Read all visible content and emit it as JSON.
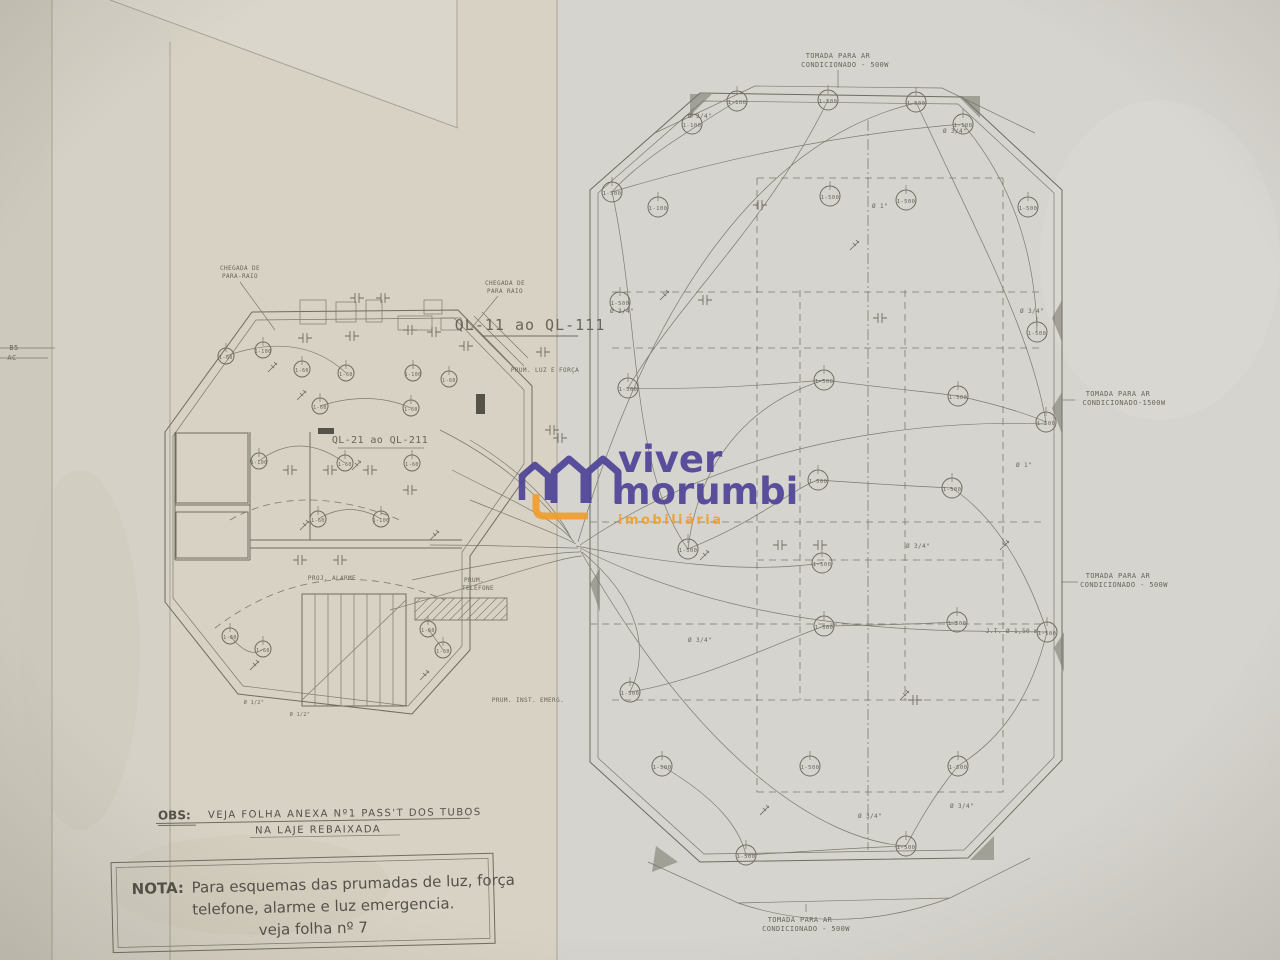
{
  "document": {
    "kind": "electrical floor plan blueprint photo",
    "panel_label_main": "QL-11 ao QL-111",
    "panel_label_secondary": "QL-21 ao QL-211"
  },
  "watermark": {
    "line1": "viver",
    "line2": "morumbi",
    "line3": "imobiliária",
    "purple": "#4f4397",
    "orange": "#f09f2e"
  },
  "obs_note": {
    "prefix": "OBS:",
    "line1": "VEJA FOLHA ANEXA Nº1 PASS'T DOS TUBOS",
    "line2": "NA LAJE REBAIXADA"
  },
  "nota_box": {
    "prefix": "NOTA:",
    "line1": "Para esquemas das prumadas de luz, força",
    "line2": "telefone, alarme e luz emergencia.",
    "line3": "veja folha nº 7"
  },
  "colors": {
    "paper": "#d4d1c9",
    "paper_warm": "#d7d2c3",
    "ink": "#6f6c60"
  },
  "annotations": [
    {
      "t": "TOMADA PARA AR",
      "x": 838,
      "y": 58,
      "fs": 7
    },
    {
      "t": "CONDICIONADO - 500W",
      "x": 845,
      "y": 67,
      "fs": 7
    },
    {
      "t": "TOMADA PARA AR",
      "x": 1118,
      "y": 396,
      "fs": 7
    },
    {
      "t": "CONDICIONADO-1500W",
      "x": 1124,
      "y": 405,
      "fs": 7
    },
    {
      "t": "TOMADA PARA AR",
      "x": 1118,
      "y": 578,
      "fs": 7
    },
    {
      "t": "CONDICIONADO - 500W",
      "x": 1124,
      "y": 587,
      "fs": 7
    },
    {
      "t": "TOMADA PARA AR",
      "x": 800,
      "y": 922,
      "fs": 7
    },
    {
      "t": "CONDICIONADO - 500W",
      "x": 806,
      "y": 931,
      "fs": 7
    },
    {
      "t": "CHEGADA DE",
      "x": 240,
      "y": 270,
      "fs": 6
    },
    {
      "t": "PARA-RAIO",
      "x": 240,
      "y": 278,
      "fs": 6
    },
    {
      "t": "CHEGADA DE",
      "x": 505,
      "y": 285,
      "fs": 6
    },
    {
      "t": "PARA RAIO",
      "x": 505,
      "y": 293,
      "fs": 6
    },
    {
      "t": "PROJ. ALARME",
      "x": 332,
      "y": 580,
      "fs": 6
    },
    {
      "t": "PRUM.",
      "x": 474,
      "y": 582,
      "fs": 6
    },
    {
      "t": "TELEFONE",
      "x": 478,
      "y": 590,
      "fs": 6
    },
    {
      "t": "PRUM. INST. EMERG.",
      "x": 528,
      "y": 702,
      "fs": 6
    },
    {
      "t": "PRUM. LUZ E FORÇA",
      "x": 545,
      "y": 372,
      "fs": 6
    },
    {
      "t": "J.T. Ø 1,50 m",
      "x": 1012,
      "y": 633,
      "fs": 6
    },
    {
      "t": "B5",
      "x": 14,
      "y": 350,
      "fs": 7
    },
    {
      "t": "AC",
      "x": 12,
      "y": 360,
      "fs": 7
    },
    {
      "t": "Ø 3/4\"",
      "x": 700,
      "y": 118,
      "fs": 6
    },
    {
      "t": "Ø 3/4\"",
      "x": 955,
      "y": 133,
      "fs": 6
    },
    {
      "t": "Ø 3/4\"",
      "x": 622,
      "y": 313,
      "fs": 6
    },
    {
      "t": "Ø 3/4\"",
      "x": 1032,
      "y": 313,
      "fs": 6
    },
    {
      "t": "Ø 3/4\"",
      "x": 918,
      "y": 548,
      "fs": 6
    },
    {
      "t": "Ø 3/4\"",
      "x": 700,
      "y": 642,
      "fs": 6
    },
    {
      "t": "Ø 3/4\"",
      "x": 870,
      "y": 818,
      "fs": 6
    },
    {
      "t": "Ø 3/4\"",
      "x": 962,
      "y": 808,
      "fs": 6
    },
    {
      "t": "Ø 1\"",
      "x": 880,
      "y": 208,
      "fs": 6
    },
    {
      "t": "Ø 1\"",
      "x": 1024,
      "y": 467,
      "fs": 6
    },
    {
      "t": "Ø 1/2\"",
      "x": 254,
      "y": 704,
      "fs": 5
    },
    {
      "t": "Ø 1/2\"",
      "x": 300,
      "y": 716,
      "fs": 5
    }
  ],
  "outlets_right": [
    {
      "x": 737,
      "y": 101,
      "l": "1-100"
    },
    {
      "x": 828,
      "y": 100,
      "l": "1-500"
    },
    {
      "x": 916,
      "y": 102,
      "l": "1-500"
    },
    {
      "x": 963,
      "y": 124,
      "l": "1-100"
    },
    {
      "x": 692,
      "y": 124,
      "l": "1-100"
    },
    {
      "x": 612,
      "y": 192,
      "l": "1-500"
    },
    {
      "x": 658,
      "y": 207,
      "l": "1-100"
    },
    {
      "x": 830,
      "y": 196,
      "l": "1-500"
    },
    {
      "x": 906,
      "y": 200,
      "l": "1-500"
    },
    {
      "x": 1028,
      "y": 207,
      "l": "1-500"
    },
    {
      "x": 620,
      "y": 302,
      "l": "1-500"
    },
    {
      "x": 1037,
      "y": 332,
      "l": "1-500"
    },
    {
      "x": 628,
      "y": 388,
      "l": "1-500"
    },
    {
      "x": 824,
      "y": 380,
      "l": "1-500"
    },
    {
      "x": 958,
      "y": 396,
      "l": "1-500"
    },
    {
      "x": 1046,
      "y": 422,
      "l": "1-500"
    },
    {
      "x": 688,
      "y": 549,
      "l": "1-500"
    },
    {
      "x": 818,
      "y": 480,
      "l": "1-500"
    },
    {
      "x": 952,
      "y": 488,
      "l": "1-500"
    },
    {
      "x": 822,
      "y": 563,
      "l": "1-500"
    },
    {
      "x": 630,
      "y": 692,
      "l": "1-500"
    },
    {
      "x": 824,
      "y": 626,
      "l": "1-500"
    },
    {
      "x": 957,
      "y": 622,
      "l": "1-500"
    },
    {
      "x": 1047,
      "y": 632,
      "l": "1-500"
    },
    {
      "x": 662,
      "y": 766,
      "l": "1-500"
    },
    {
      "x": 810,
      "y": 766,
      "l": "1-500"
    },
    {
      "x": 958,
      "y": 766,
      "l": "1-500"
    },
    {
      "x": 746,
      "y": 855,
      "l": "1-500"
    },
    {
      "x": 906,
      "y": 846,
      "l": "1-500"
    }
  ],
  "outlets_left": [
    {
      "x": 226,
      "y": 356,
      "l": "1-60"
    },
    {
      "x": 263,
      "y": 350,
      "l": "1-100"
    },
    {
      "x": 302,
      "y": 369,
      "l": "1-60"
    },
    {
      "x": 346,
      "y": 373,
      "l": "1-60"
    },
    {
      "x": 413,
      "y": 373,
      "l": "1-100"
    },
    {
      "x": 449,
      "y": 379,
      "l": "1-60"
    },
    {
      "x": 320,
      "y": 406,
      "l": "1-60"
    },
    {
      "x": 411,
      "y": 408,
      "l": "1-60"
    },
    {
      "x": 259,
      "y": 461,
      "l": "1-100"
    },
    {
      "x": 345,
      "y": 463,
      "l": "1-60"
    },
    {
      "x": 412,
      "y": 463,
      "l": "1-60"
    },
    {
      "x": 318,
      "y": 519,
      "l": "1-60"
    },
    {
      "x": 381,
      "y": 519,
      "l": "1-100"
    },
    {
      "x": 230,
      "y": 636,
      "l": "1-60"
    },
    {
      "x": 263,
      "y": 649,
      "l": "1-60"
    },
    {
      "x": 428,
      "y": 629,
      "l": "1-60"
    },
    {
      "x": 443,
      "y": 650,
      "l": "1-60"
    }
  ]
}
